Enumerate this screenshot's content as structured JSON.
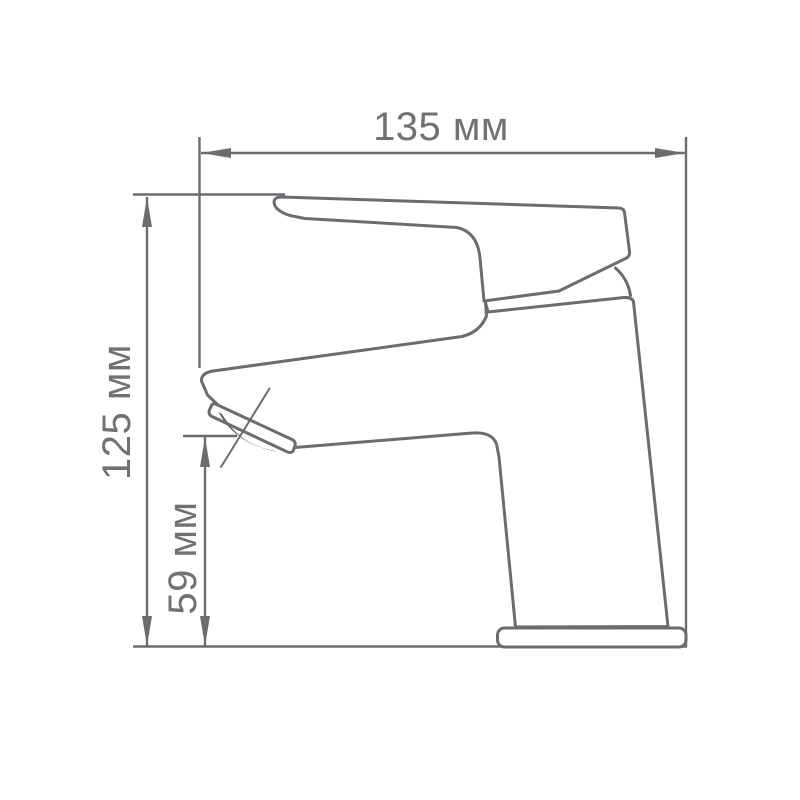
{
  "drawing": {
    "unit": "мм",
    "colors": {
      "background": "#ffffff",
      "line": "#6a6d70",
      "text": "#6f7275",
      "aerator": "#64676a"
    },
    "dimensions": {
      "overall_width": {
        "value": 135,
        "unit": "мм",
        "label": "135 мм"
      },
      "overall_height": {
        "value": 125,
        "unit": "мм",
        "label": "125 мм"
      },
      "spout_height": {
        "value": 59,
        "unit": "мм",
        "label": "59 мм"
      }
    }
  }
}
